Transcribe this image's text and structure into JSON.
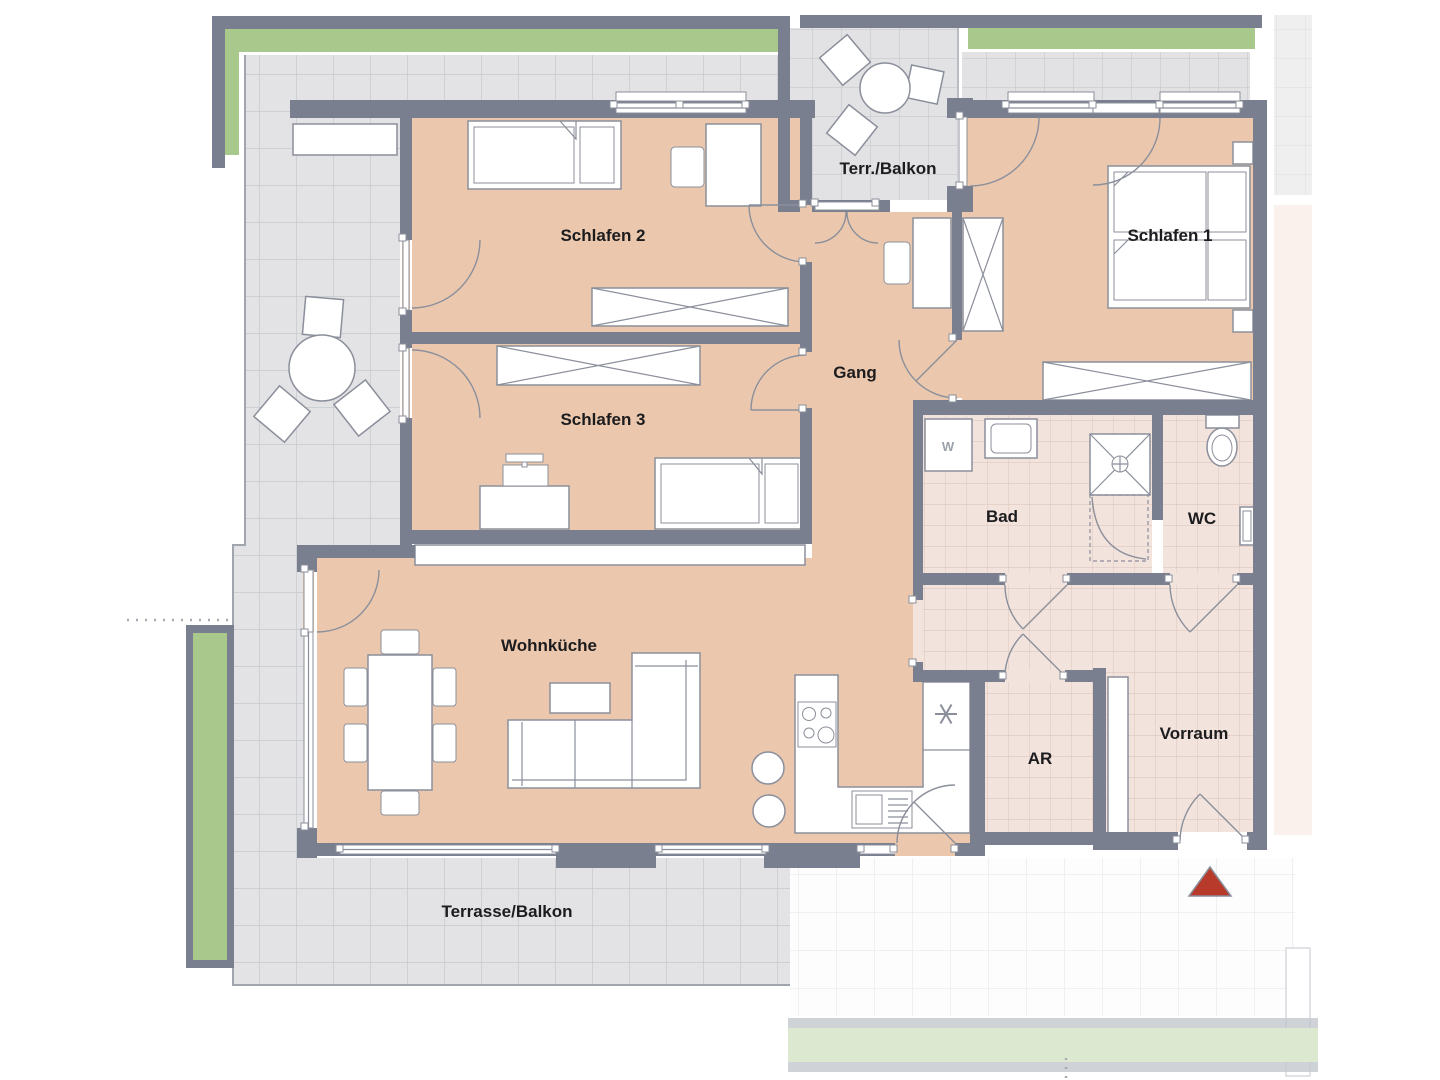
{
  "title": "Apartment floor plan",
  "labels": {
    "schlafen1": "Schlafen 1",
    "schlafen2": "Schlafen 2",
    "schlafen3": "Schlafen 3",
    "gang": "Gang",
    "bad": "Bad",
    "wc": "WC",
    "wohnkueche": "Wohnküche",
    "ar": "AR",
    "vorraum": "Vorraum",
    "terr_balkon": "Terr./Balkon",
    "terrasse_balkon": "Terrasse/Balkon",
    "waschmaschine": "W"
  },
  "colors": {
    "room_floor": "#ebc8ad",
    "wall": "#7a7f8f",
    "terrace_tile": "#e3e3e5",
    "bath_tile": "#f3e3dd",
    "planter_green": "#a9c98c",
    "planter_green_faded": "#dce8cf",
    "entrance_marker": "#b73a2b"
  }
}
